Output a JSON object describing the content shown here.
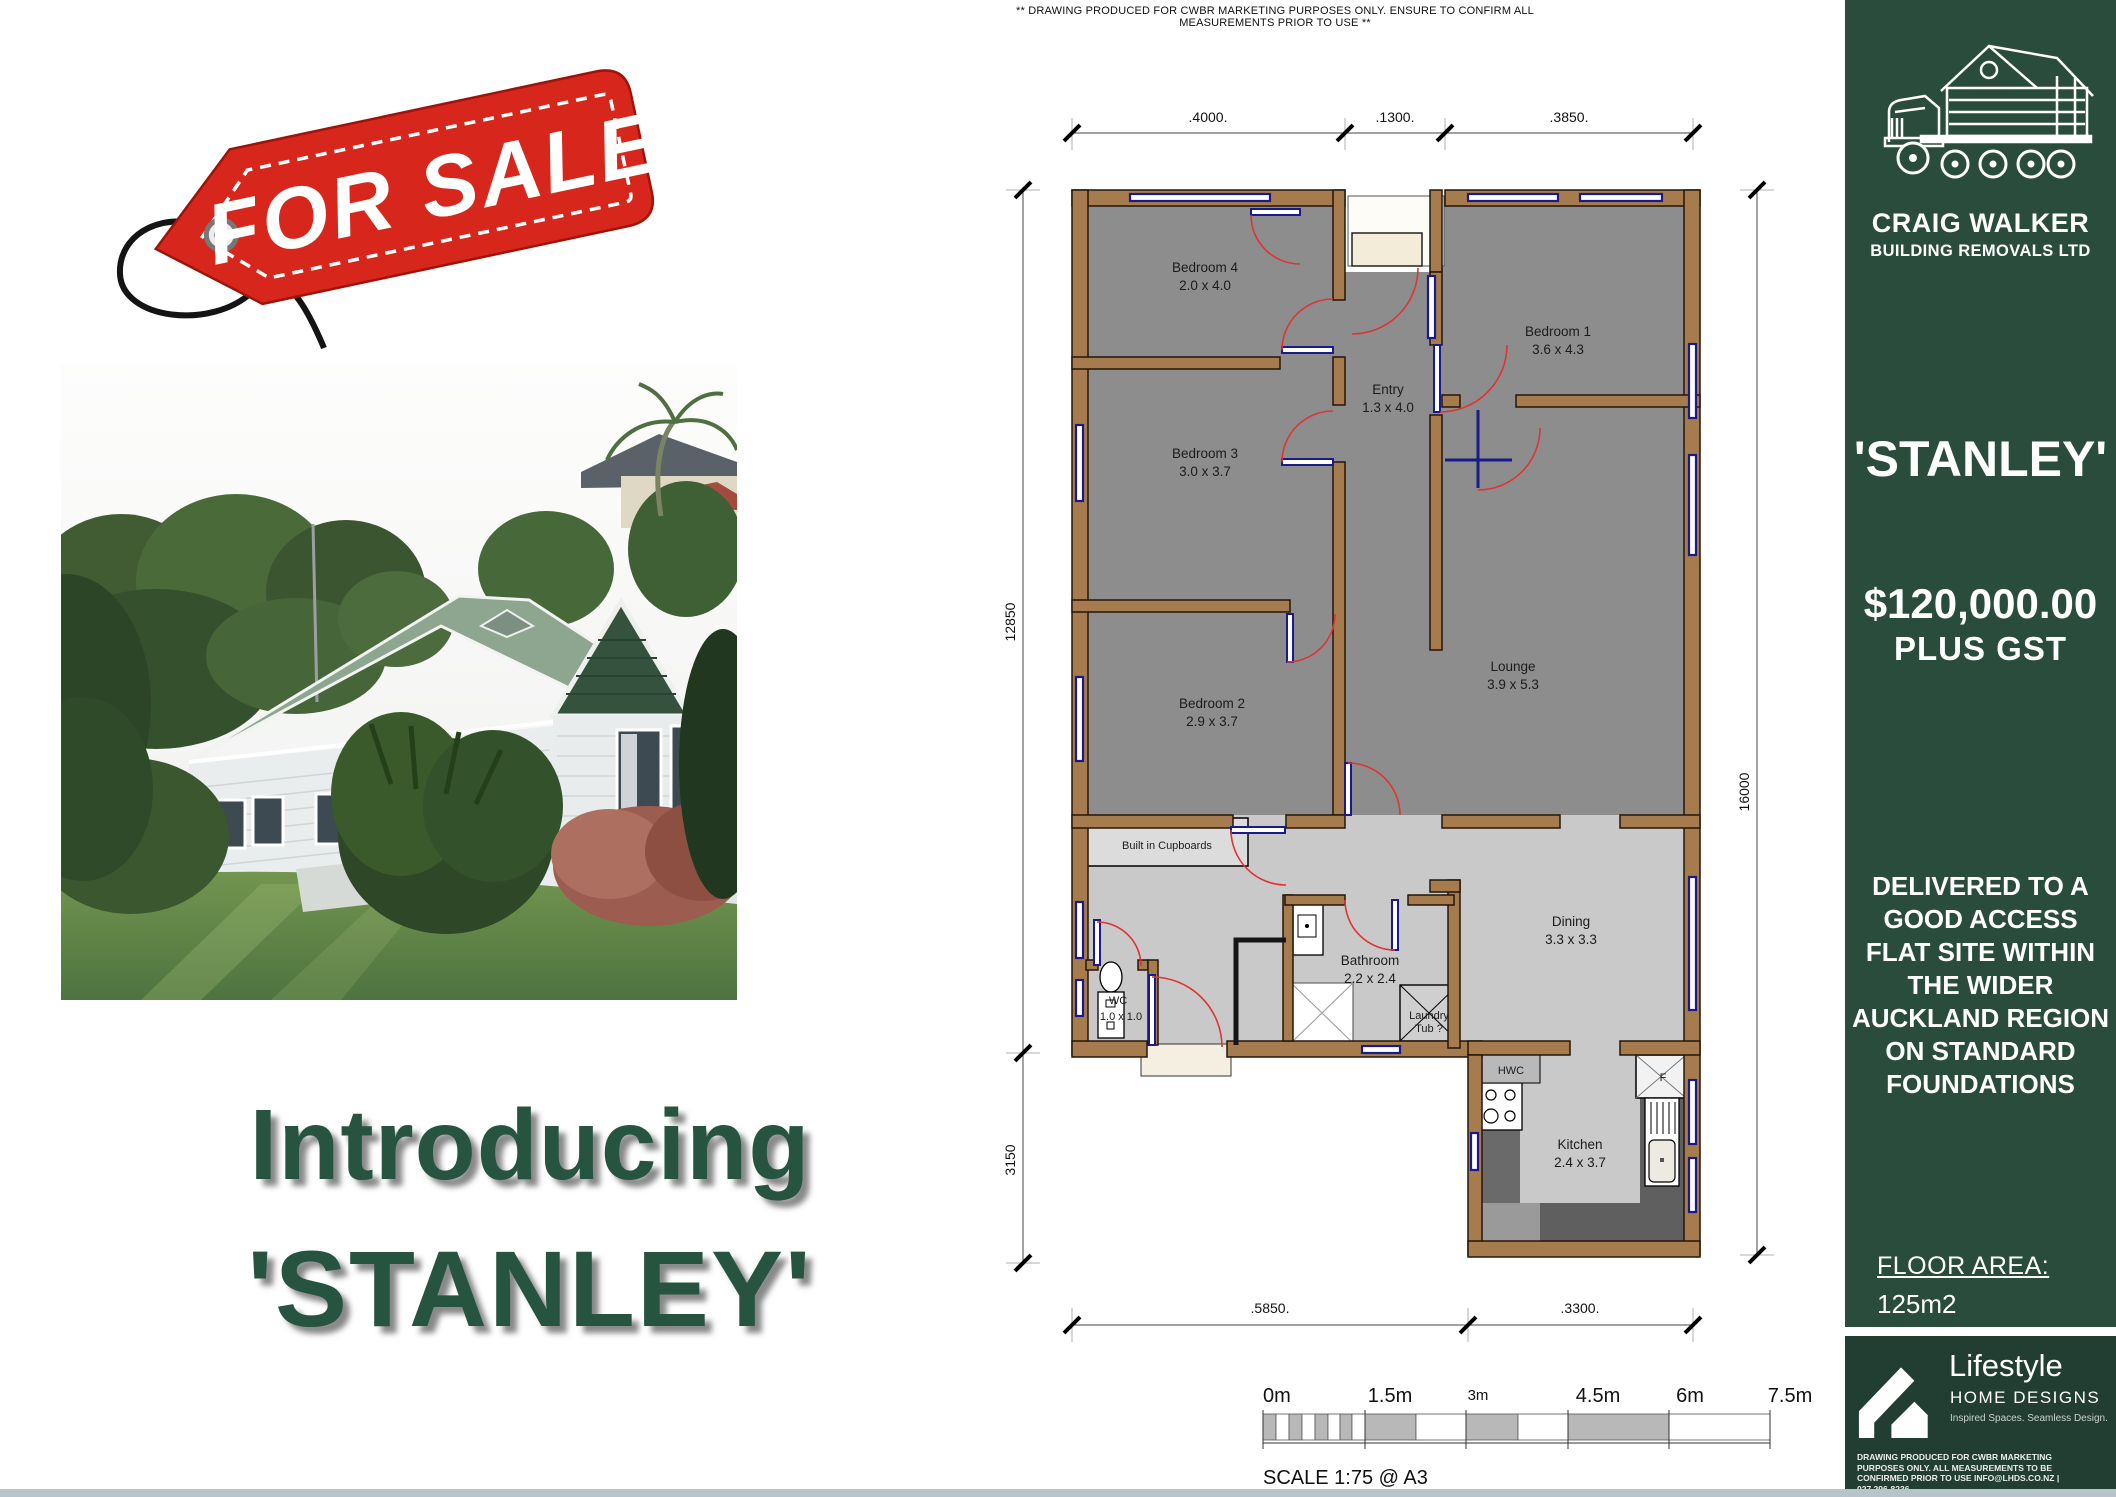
{
  "theme": {
    "green": "#2a4c3c",
    "green_dark": "#20niner",
    "yellow": "#eed23c",
    "intro_green": "#265441",
    "tag_red": "#d7271c",
    "wall_brown": "#a67c4e",
    "floor_dark": "#8d8d8d",
    "floor_light": "#c9c9c9",
    "door_red": "#e03434",
    "window_blue": "#1a1a8c"
  },
  "disclaimer": "** DRAWING PRODUCED FOR CWBR MARKETING PURPOSES ONLY. ENSURE TO CONFIRM ALL MEASUREMENTS PRIOR TO USE **",
  "tag": {
    "label": "FOR SALE"
  },
  "intro": {
    "line1": "Introducing",
    "line2": "'STANLEY'"
  },
  "sidebar": {
    "brand": {
      "name": "CRAIG WALKER",
      "subtitle": "BUILDING REMOVALS LTD"
    },
    "property_name": "'STANLEY'",
    "price": "$120,000.00",
    "price_note": "PLUS GST",
    "delivery_lines": [
      "DELIVERED TO A",
      "GOOD ACCESS",
      "FLAT SITE WITHIN",
      "THE WIDER",
      "AUCKLAND REGION",
      "ON STANDARD",
      "FOUNDATIONS"
    ],
    "floor_area_label": "FLOOR AREA:",
    "floor_area_value": "125m2",
    "designer": {
      "name": "Lifestyle",
      "type": "HOME DESIGNS",
      "tagline": "Inspired Spaces. Seamless Design.",
      "fineprint_lines": [
        "DRAWING PRODUCED FOR CWBR MARKETING",
        "PURPOSES ONLY. ALL MEASUREMENTS TO BE",
        "CONFIRMED PRIOR TO USE INFO@LHDS.CO.NZ |",
        "027 296-8236"
      ]
    }
  },
  "plan": {
    "rooms": [
      {
        "name": "Bedroom 4",
        "dims": "2.0 x 4.0"
      },
      {
        "name": "Bedroom 1",
        "dims": "3.6 x 4.3"
      },
      {
        "name": "Entry",
        "dims": "1.3 x 4.0"
      },
      {
        "name": "Bedroom 3",
        "dims": "3.0 x 3.7"
      },
      {
        "name": "Bedroom 2",
        "dims": "2.9 x 3.7"
      },
      {
        "name": "Lounge",
        "dims": "3.9 x 5.3"
      },
      {
        "name": "Bathroom",
        "dims": "2.2 x 2.4"
      },
      {
        "name": "WC",
        "dims": "1.0 x 1.0"
      },
      {
        "name": "Dining",
        "dims": "3.3 x 3.3"
      },
      {
        "name": "Kitchen",
        "dims": "2.4 x 3.7"
      }
    ],
    "labels": {
      "built_in": "Built in Cupboards",
      "laundry_1": "Laundry",
      "laundry_2": "Tub ?",
      "hwc": "HWC",
      "fridge": "F"
    },
    "dims": {
      "top": [
        ".4000.",
        ".1300.",
        ".3850."
      ],
      "left_upper": "12850",
      "left_lower": "3150",
      "right": "16000",
      "bottom": [
        ".5850.",
        ".3300."
      ]
    },
    "scale": {
      "labels": [
        "0m",
        "1.5m",
        "3m",
        "4.5m",
        "6m",
        "7.5m"
      ],
      "caption": "SCALE 1:75  @ A3"
    }
  }
}
